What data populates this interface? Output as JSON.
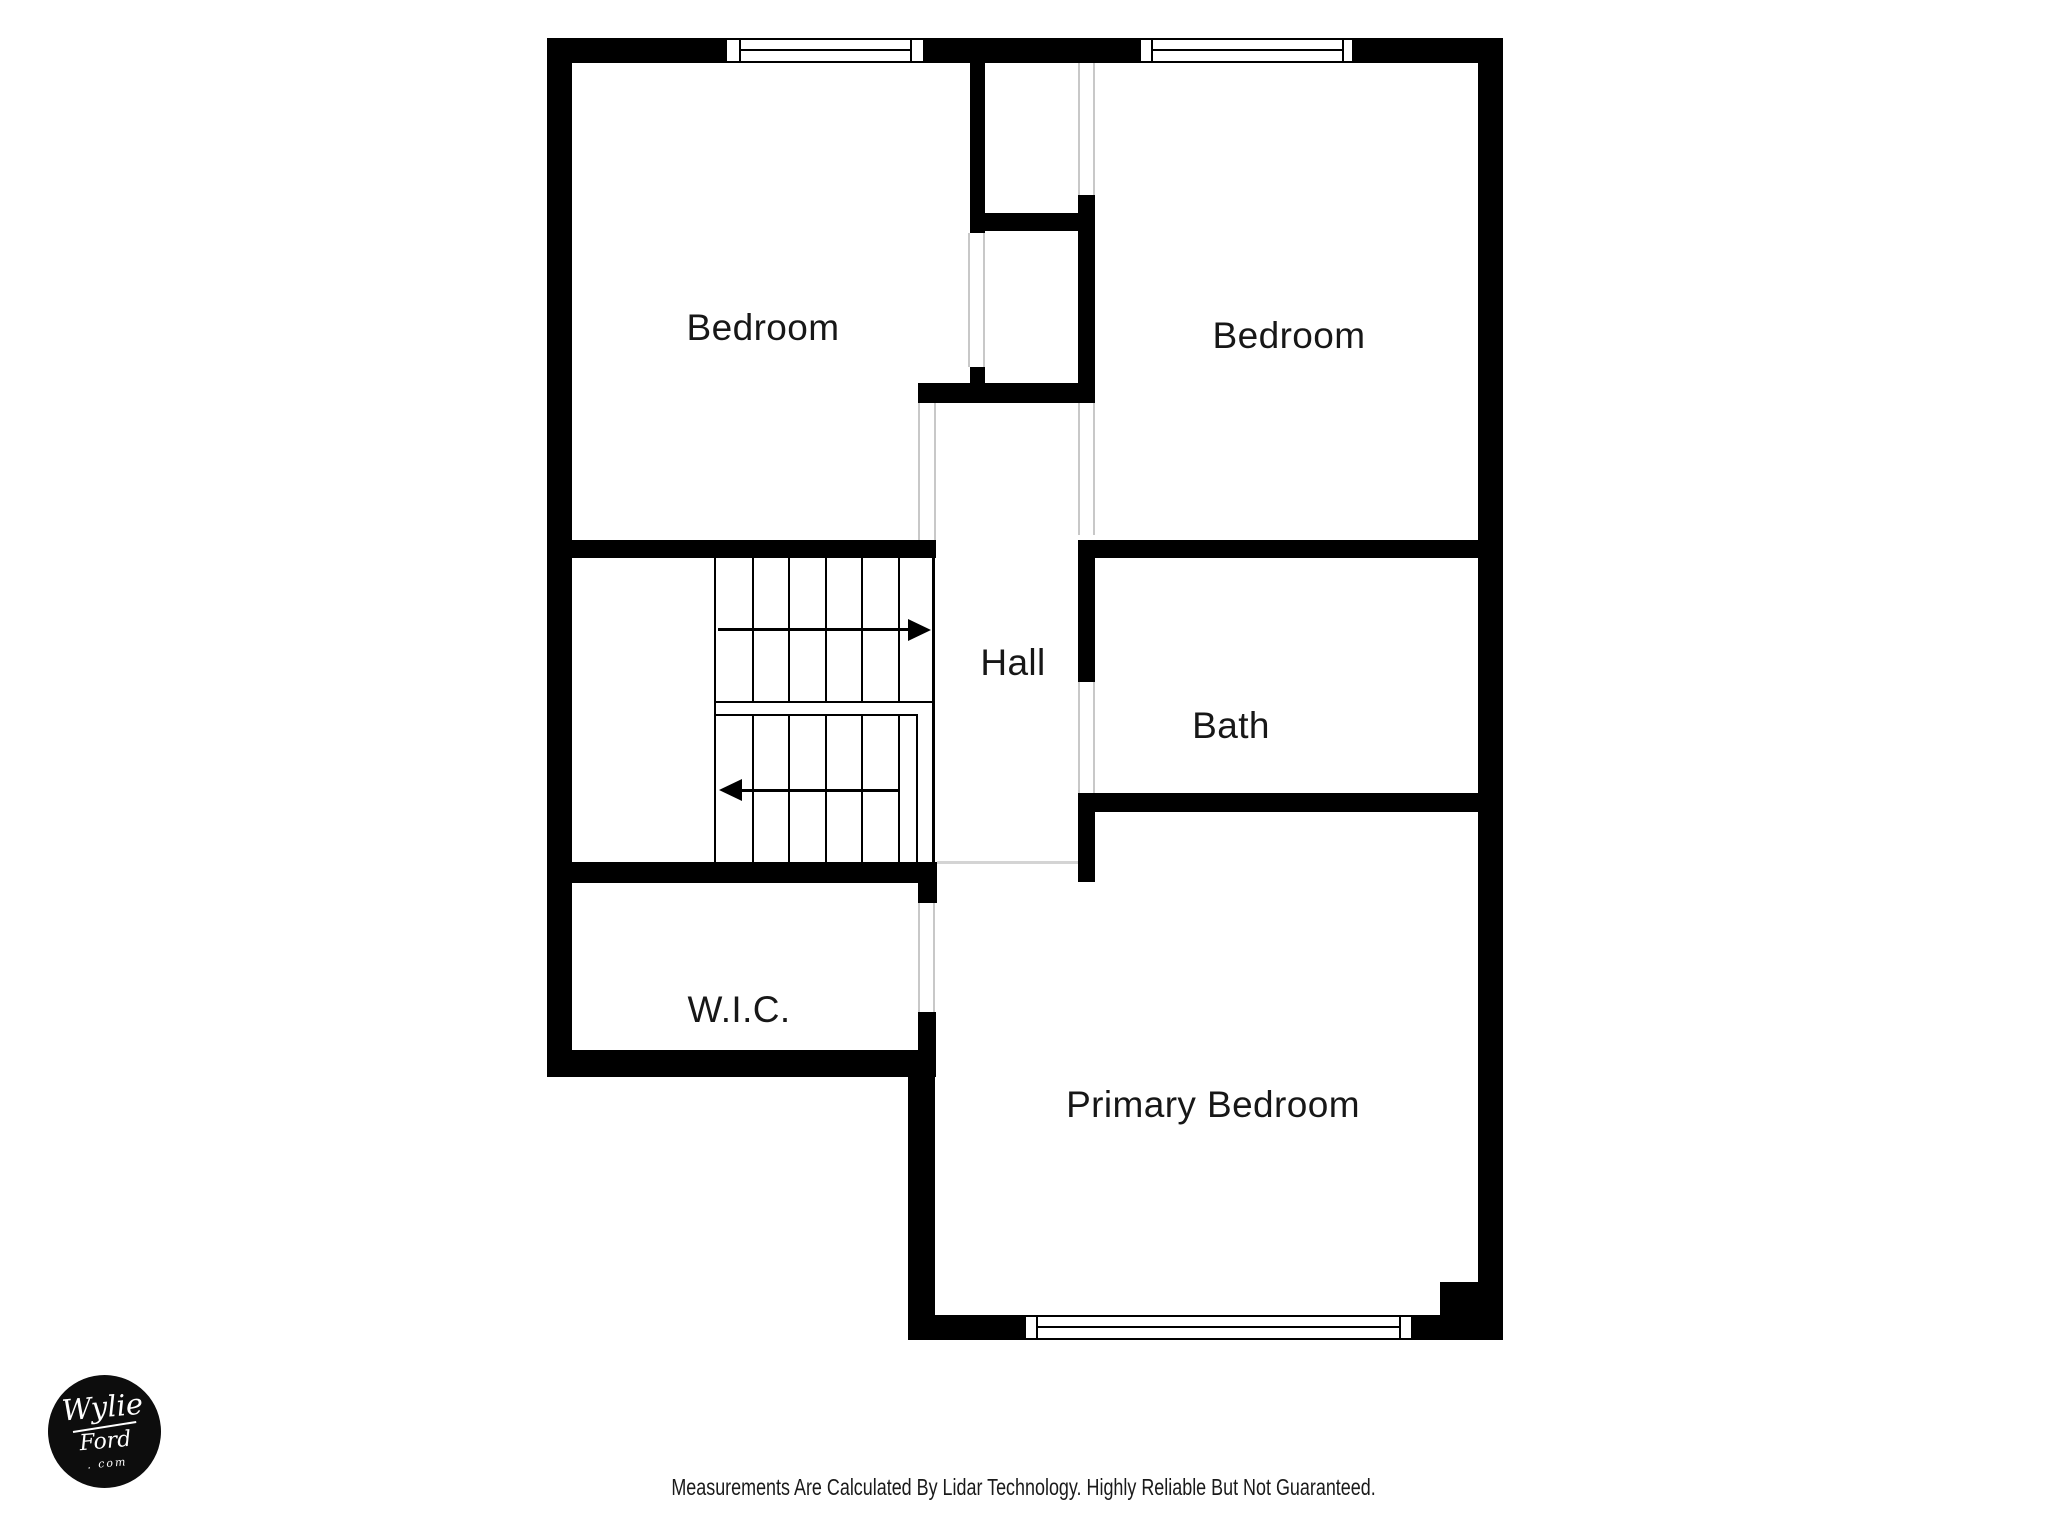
{
  "rooms": {
    "bedroom_left": "Bedroom",
    "bedroom_right": "Bedroom",
    "hall": "Hall",
    "bath": "Bath",
    "wic": "W.I.C.",
    "primary_bedroom": "Primary Bedroom"
  },
  "footer": {
    "disclaimer": "Measurements Are Calculated By Lidar Technology. Highly Reliable But Not Guaranteed."
  },
  "logo": {
    "line1": "Wylie",
    "line2": "Ford",
    "line3": ". com"
  },
  "colors": {
    "wall": "#000000",
    "background": "#ffffff",
    "door_jamb": "#c8c8c8",
    "room_separator": "#d4d4d4",
    "label_text": "#171717",
    "footer_text": "#1a1a1a",
    "logo_background": "#0d0d0d",
    "logo_text": "#ffffff"
  }
}
